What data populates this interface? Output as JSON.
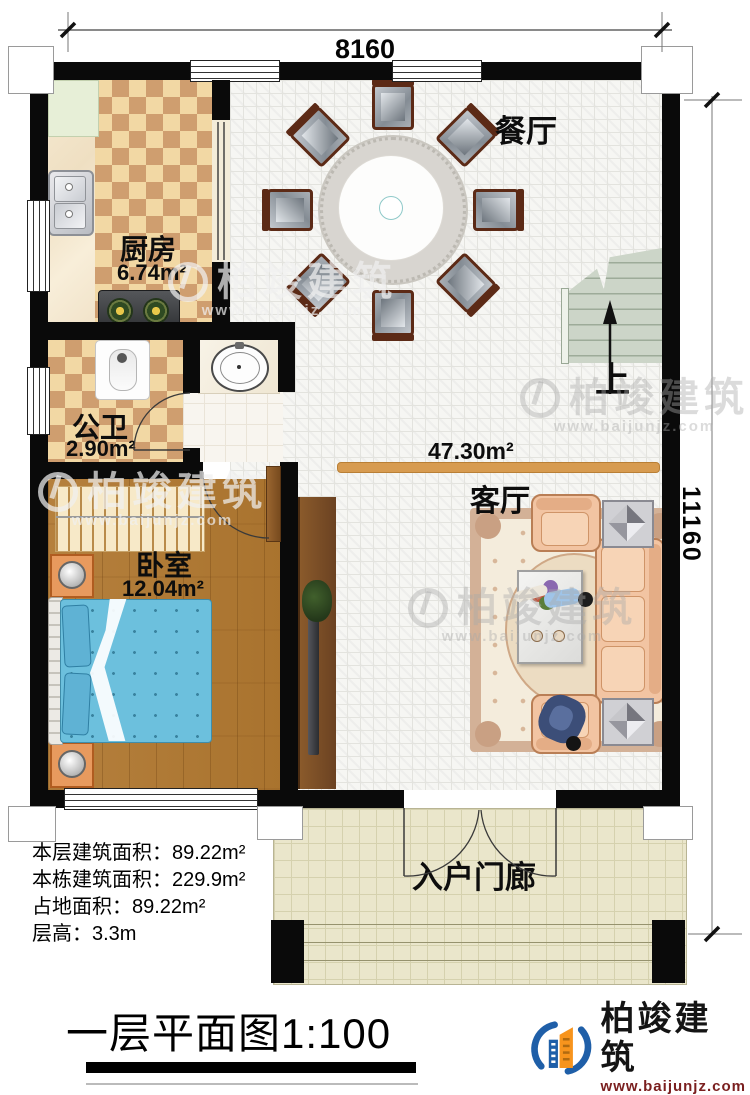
{
  "dimensions": {
    "top": "8160",
    "right": "11160"
  },
  "rooms": {
    "dining": {
      "name": "餐厅"
    },
    "kitchen": {
      "name": "厨房",
      "area": "6.74m²"
    },
    "bathroom": {
      "name": "公卫",
      "area": "2.90m²"
    },
    "bedroom": {
      "name": "卧室",
      "area": "12.04m²"
    },
    "living": {
      "name": "客厅",
      "area": "47.30m²"
    },
    "porch": {
      "name": "入户门廊"
    },
    "stairs": {
      "direction_label": "上"
    }
  },
  "stats": {
    "lines": [
      {
        "label": "本层建筑面积：",
        "value": "89.22m²"
      },
      {
        "label": "本栋建筑面积：",
        "value": "229.9m²"
      },
      {
        "label": "占地面积：",
        "value": "89.22m²"
      },
      {
        "label": "层高：",
        "value": "3.3m"
      }
    ]
  },
  "footer": {
    "plan_title": "一层平面图",
    "scale": "1:100"
  },
  "brand": {
    "name": "柏竣建筑",
    "url": "www.baijunjz.com"
  },
  "colors": {
    "logo_blue": "#1f5fa8",
    "logo_orange": "#f7941d",
    "url_red": "#7a1f1f"
  }
}
